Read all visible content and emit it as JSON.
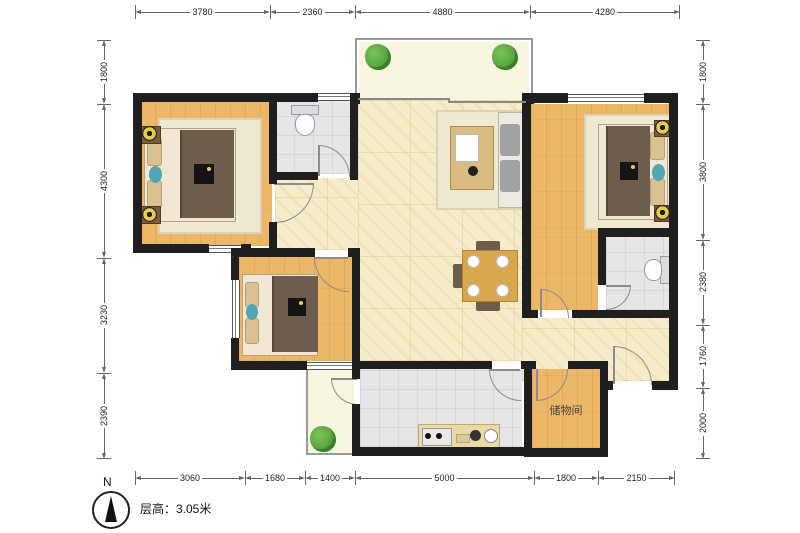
{
  "floor_plan": {
    "storage_room_label": "储物间",
    "floor_height_note": "层高：3.05米",
    "compass_north": "N",
    "dimensions_top": [
      {
        "value": "3780"
      },
      {
        "value": "2360"
      },
      {
        "value": "4880"
      },
      {
        "value": "4280"
      }
    ],
    "dimensions_bottom": [
      {
        "value": "3060"
      },
      {
        "value": "1680"
      },
      {
        "value": "1400"
      },
      {
        "value": "5000"
      },
      {
        "value": "1800"
      },
      {
        "value": "2150"
      }
    ],
    "dimensions_left": [
      {
        "value": "1800"
      },
      {
        "value": "4300"
      },
      {
        "value": "3230"
      },
      {
        "value": "2390"
      }
    ],
    "dimensions_right": [
      {
        "value": "1800"
      },
      {
        "value": "3800"
      },
      {
        "value": "2380"
      },
      {
        "value": "1760"
      },
      {
        "value": "2000"
      }
    ],
    "colors": {
      "wall": "#1f1f1f",
      "wood_floor": "#ecb868",
      "tile_floor": "#e6e6e8",
      "marble_floor": "#f5ecca",
      "balcony_floor": "#f8f6e0",
      "accent_teal": "#4fa6b5",
      "plant_green": "#4f9e3c",
      "lamp_yellow": "#e5cc4a",
      "dim_line": "#666"
    }
  }
}
